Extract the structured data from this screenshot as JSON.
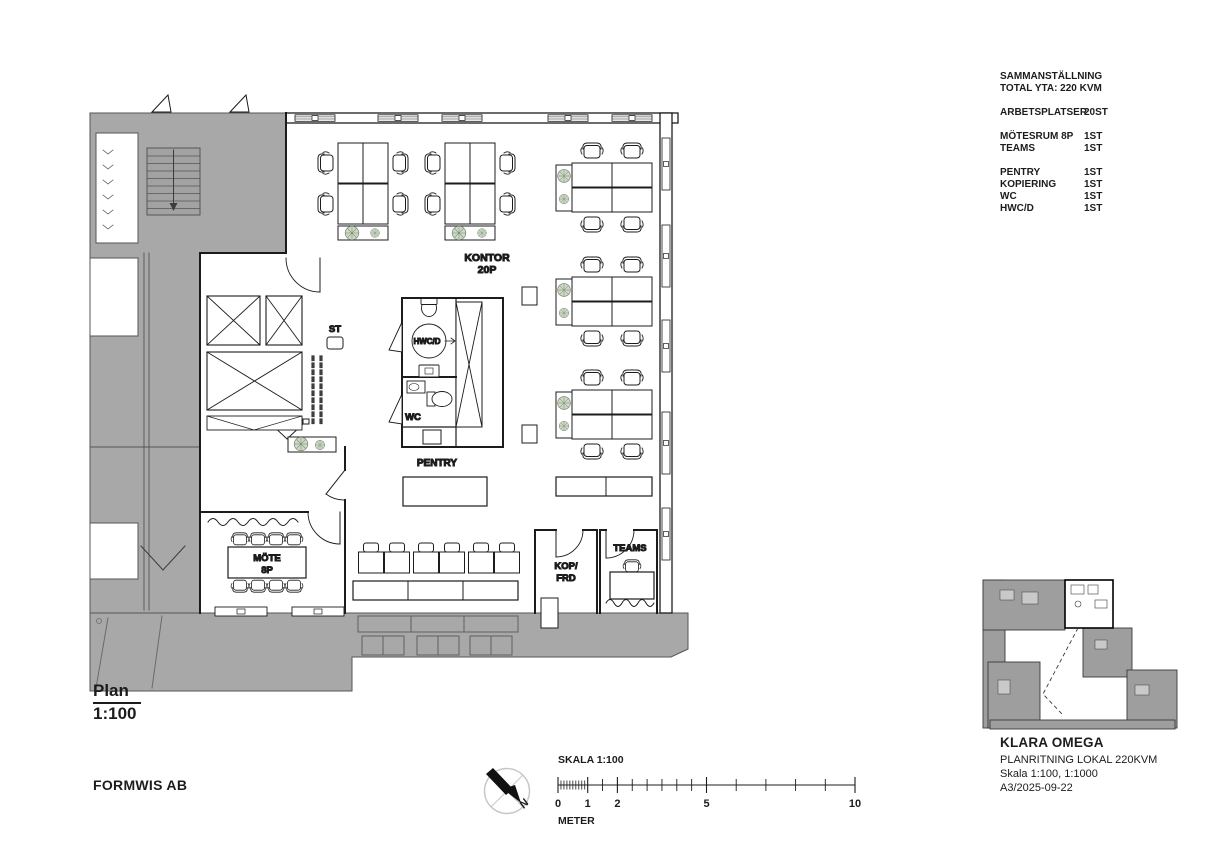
{
  "colors": {
    "ink": "#1c1c1c",
    "common_gray": "#a8a8a8",
    "map_gray": "#9e9e9e",
    "plant_green": "#cdd8c6",
    "compass_gray": "#c6c6c6"
  },
  "summary": {
    "title": "SAMMANSTÄLLNING",
    "total": "TOTAL YTA: 220 KVM",
    "groups": [
      {
        "rows": [
          {
            "label": "ARBETSPLATSER",
            "value": "20ST"
          }
        ]
      },
      {
        "rows": [
          {
            "label": "MÖTESRUM 8P",
            "value": "1ST"
          },
          {
            "label": "TEAMS",
            "value": "1ST"
          }
        ]
      },
      {
        "rows": [
          {
            "label": "PENTRY",
            "value": "1ST"
          },
          {
            "label": "KOPIERING",
            "value": "1ST"
          },
          {
            "label": "WC",
            "value": "1ST"
          },
          {
            "label": "HWC/D",
            "value": "1ST"
          }
        ]
      }
    ]
  },
  "plan": {
    "rooms": {
      "kontor": "KONTOR",
      "kontor_p": "20P",
      "st": "ST",
      "hwcd": "HWC/D",
      "wc": "WC",
      "pentry": "PENTRY",
      "mote": "MÖTE",
      "mote_p": "8P",
      "kop_line1": "KOP/",
      "kop_line2": "FRD",
      "teams": "TEAMS"
    }
  },
  "drawing_title": {
    "name": "Plan",
    "scale": "1:100"
  },
  "company": "FORMWIS AB",
  "scalebar": {
    "label": "SKALA 1:100",
    "unit": "METER",
    "ticks": [
      "0",
      "1",
      "2",
      "5",
      "10"
    ]
  },
  "north_label": "N",
  "titleblock": {
    "project": "KLARA OMEGA",
    "subtitle": "PLANRITNING LOKAL 220KVM",
    "scale_line": "Skala 1:100, 1:1000",
    "sheet_line": "A3/2025-09-22"
  }
}
